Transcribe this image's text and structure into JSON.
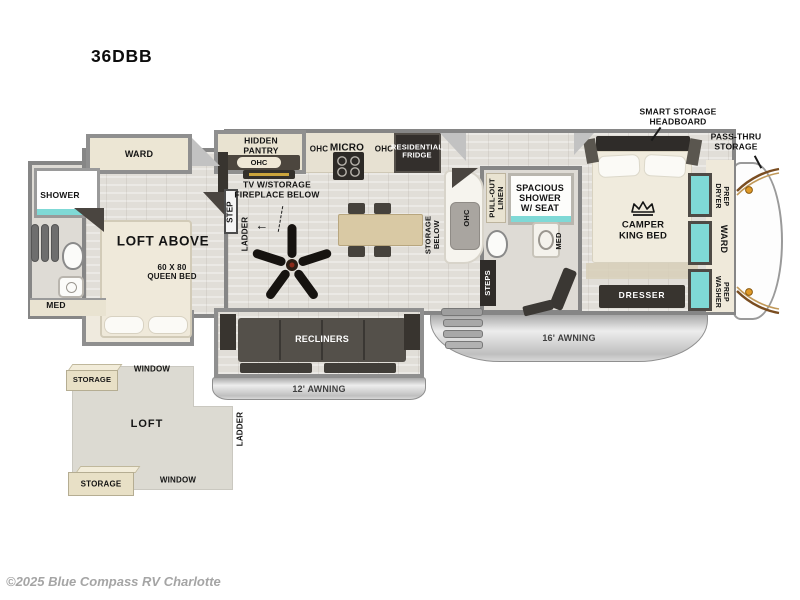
{
  "title": "36DBB",
  "copyright": "©2025 Blue Compass RV Charlotte",
  "colors": {
    "window_glass": "#7fd9d6",
    "marker_light": "#e09a28",
    "cap_accent_brown": "#7a4d20",
    "awning_silver": "#c9c9c9",
    "watermark_gray": "#a5a5a5"
  },
  "rear_bath": {
    "shower": "SHOWER",
    "med": "MED"
  },
  "bunk_room": {
    "ward": "WARD",
    "loft_above": "LOFT ABOVE",
    "queen_bed": "60 X 80\nQUEEN BED",
    "step": "STEP",
    "ladder": "LADDER"
  },
  "kitchen": {
    "hidden_pantry": "HIDDEN\nPANTRY",
    "pantry_ohc": "OHC",
    "ohc_left": "OHC",
    "micro": "MICRO",
    "ohc_right": "OHC",
    "fridge": "RESIDENTIAL\nFRIDGE",
    "tv": "TV W/STORAGE\nFIREPLACE BELOW",
    "tv_arrow": "←",
    "island_storage": "STORAGE\nBELOW",
    "counter_ohc": "OHC"
  },
  "living": {
    "recliners": "RECLINERS",
    "awning_12": "12' AWNING"
  },
  "mid_bath": {
    "linen": "PULL-OUT\nLINEN",
    "shower": "SPACIOUS\nSHOWER\nW/ SEAT",
    "med": "MED",
    "steps": "STEPS"
  },
  "bedroom": {
    "headboard": "SMART STORAGE\nHEADBOARD",
    "pass_thru": "PASS-THRU\nSTORAGE",
    "king_bed": "CAMPER\nKING BED",
    "dresser": "DRESSER",
    "dryer_prep": "DRYER\nPREP",
    "ward": "WARD",
    "washer_prep": "WASHER\nPREP",
    "awning_16": "16' AWNING"
  },
  "loft": {
    "storage_top": "STORAGE",
    "window_top": "WINDOW",
    "loft": "LOFT",
    "ladder": "LADDER",
    "storage_bottom": "STORAGE",
    "window_bottom": "WINDOW"
  }
}
